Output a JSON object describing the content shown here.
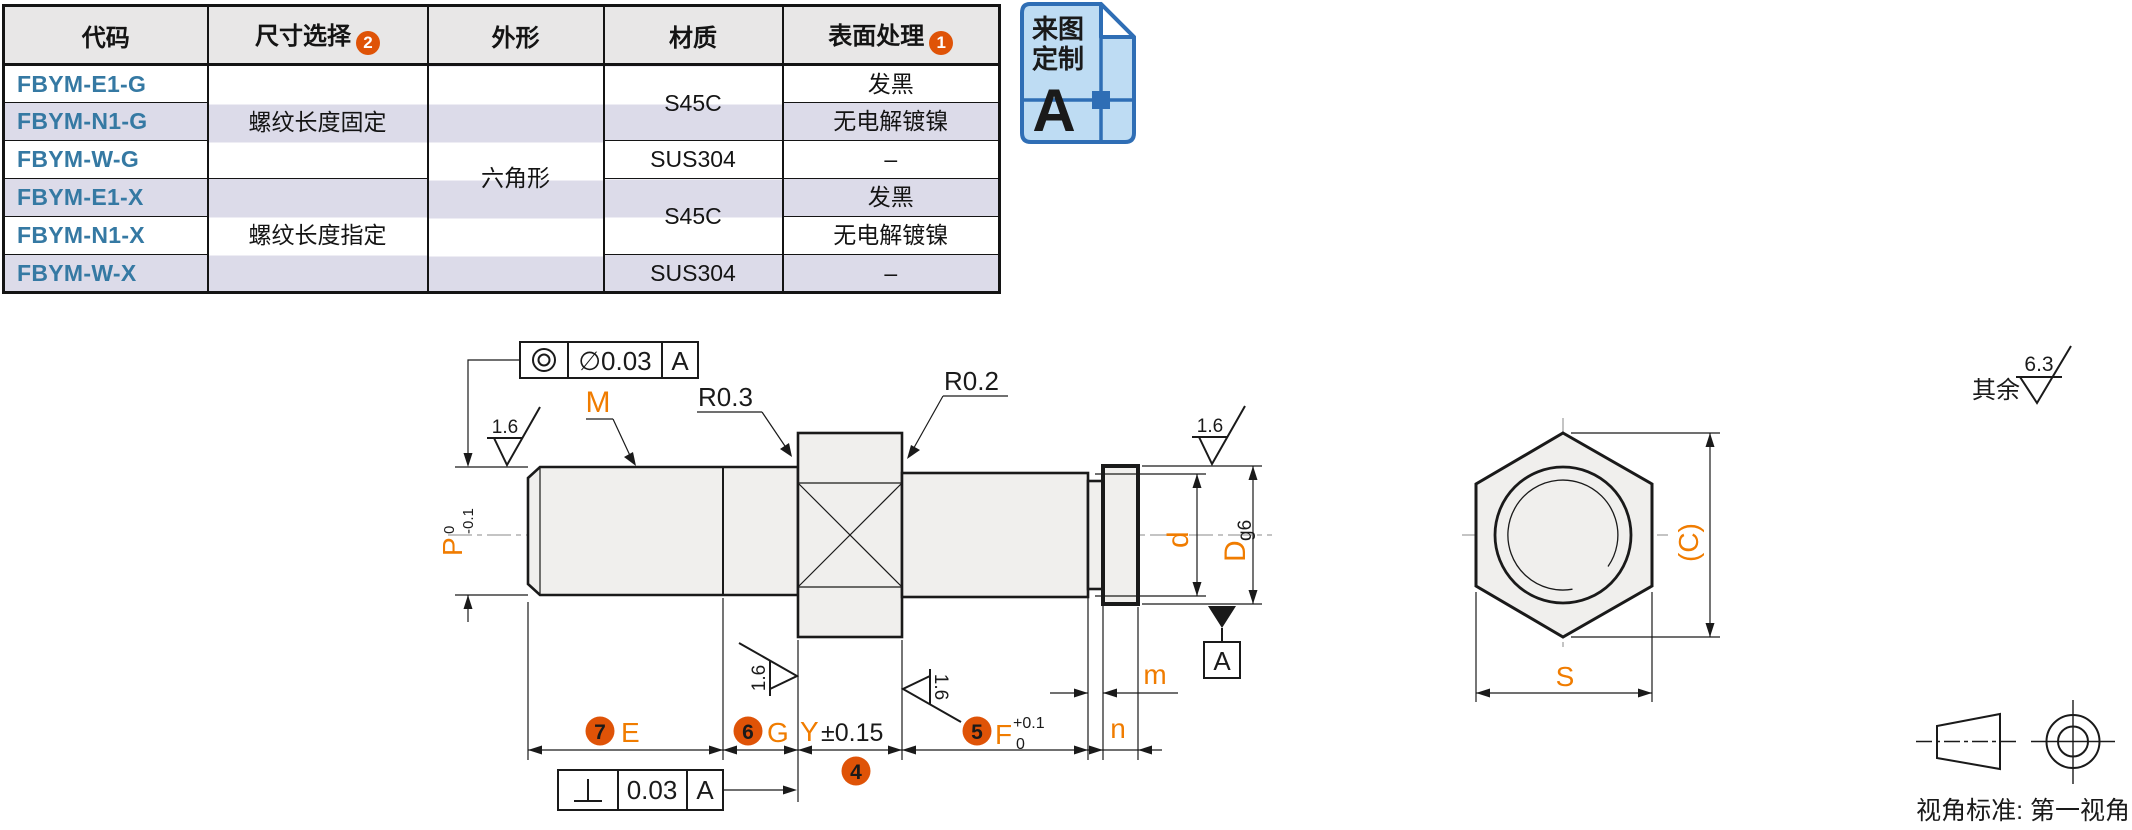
{
  "colors": {
    "accent_orange": "#f07c00",
    "badge_orange": "#df5307",
    "code_blue": "#3579a3",
    "stripe_lavender": "#dcdbe9",
    "header_gray": "#e8e7e7",
    "doc_badge_blue": "#2f6eb5",
    "doc_badge_fill": "#bedcf3"
  },
  "table": {
    "headers": [
      "代码",
      "尺寸选择",
      "外形",
      "材质",
      "表面处理"
    ],
    "header_badges": {
      "size": "2",
      "surface": "1"
    },
    "codes": [
      "FBYM-E1-G",
      "FBYM-N1-G",
      "FBYM-W-G",
      "FBYM-E1-X",
      "FBYM-N1-X",
      "FBYM-W-X"
    ],
    "size_groups": [
      "螺纹长度固定",
      "螺纹长度指定"
    ],
    "shape": "六角形",
    "material_groups": [
      "S45C",
      "SUS304",
      "S45C",
      "SUS304"
    ],
    "surface_treatments": [
      "发黑",
      "无电解镀镍",
      "–",
      "发黑",
      "无电解镀镍",
      "–"
    ]
  },
  "custom_badge": {
    "line1": "来图",
    "line2": "定制",
    "letter": "A"
  },
  "drawing": {
    "labels": {
      "m_thread": "M",
      "r03": "R0.3",
      "r02": "R0.2",
      "ra": "1.6",
      "p": "P",
      "p_tol_top": "0",
      "p_tol_bottom": "-0.1",
      "e": "E",
      "g": "G",
      "y": "Y",
      "y_tol": "±0.15",
      "f": "F",
      "f_tol_top": "+0.1",
      "f_tol_bottom": "0",
      "m": "m",
      "n": "n",
      "d": "d",
      "dd": "D",
      "dd_fit": "g6",
      "datum": "A"
    },
    "badges": {
      "b4": "4",
      "b5": "5",
      "b6": "6",
      "b7": "7"
    },
    "fcf_concentricity": {
      "value": "∅0.03",
      "datum": "A"
    },
    "fcf_perpendicularity": {
      "value": "0.03",
      "datum": "A"
    }
  },
  "hex_view": {
    "s": "S",
    "c": "(C)"
  },
  "surface_note": {
    "prefix": "其余",
    "value": "6.3"
  },
  "projection": {
    "caption": "视角标准: 第一视角"
  }
}
